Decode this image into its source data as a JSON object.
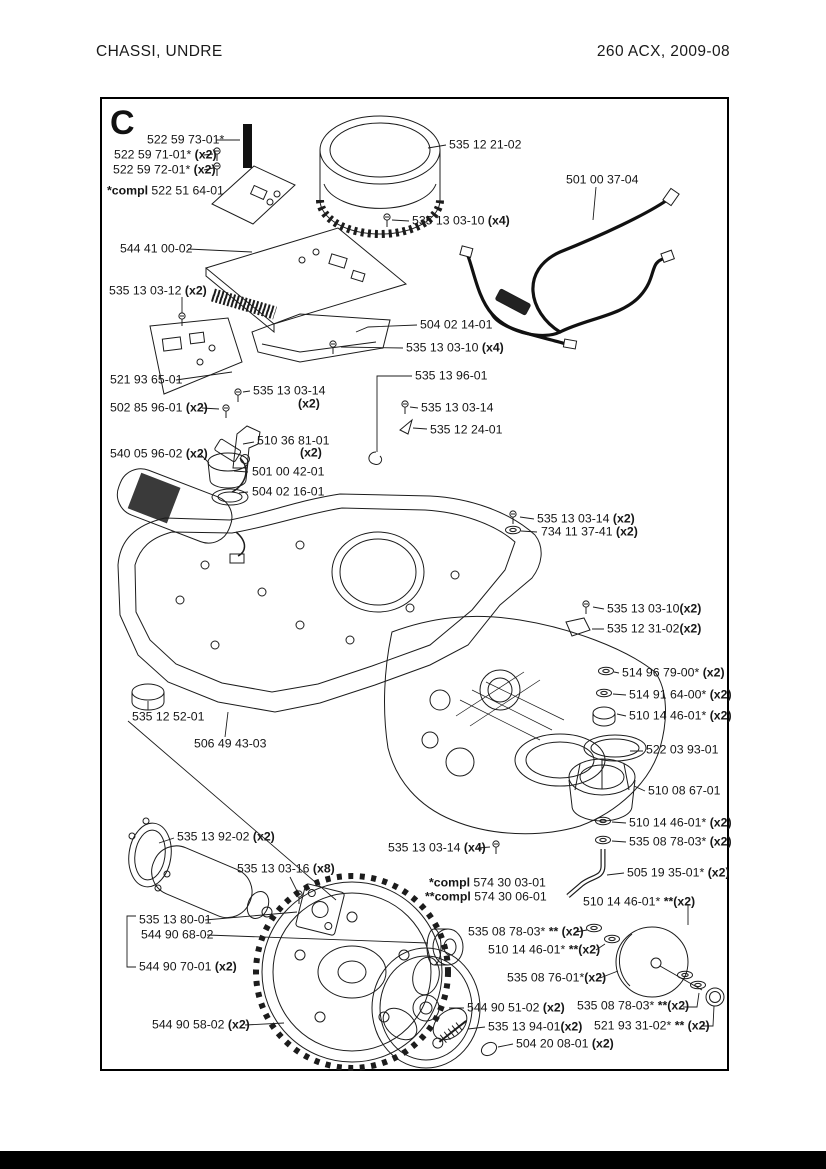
{
  "page": {
    "header_left": "CHASSI, UNDRE",
    "header_right": "260 ACX, 2009-08",
    "section_letter": "C"
  },
  "colors": {
    "line": "#1c1c1c",
    "background": "#ffffff",
    "footer_bar": "#000000"
  },
  "labels": [
    {
      "pre": "",
      "num": "522 59 73-01*",
      "qty": "",
      "x": 147,
      "y": 140
    },
    {
      "pre": "",
      "num": "522 59 71-01*",
      "qty": " (x2)",
      "x": 114,
      "y": 155
    },
    {
      "pre": "",
      "num": "522 59 72-01*",
      "qty": " (x2)",
      "x": 113,
      "y": 170
    },
    {
      "pre": "*compl ",
      "num": "522 51 64-01",
      "qty": "",
      "x": 107,
      "y": 191
    },
    {
      "pre": "",
      "num": "535 12 21-02",
      "qty": "",
      "x": 449,
      "y": 145
    },
    {
      "pre": "",
      "num": "501 00 37-04",
      "qty": "",
      "x": 566,
      "y": 180
    },
    {
      "pre": "",
      "num": "544 41 00-02",
      "qty": "",
      "x": 120,
      "y": 249
    },
    {
      "pre": "",
      "num": "535 13 03-10 ",
      "qty": "(x4)",
      "x": 412,
      "y": 221
    },
    {
      "pre": "",
      "num": "535 13 03-12 ",
      "qty": "(x2)",
      "x": 109,
      "y": 291
    },
    {
      "pre": "",
      "num": "504 02 14-01",
      "qty": "",
      "x": 420,
      "y": 325
    },
    {
      "pre": "",
      "num": "535 13 03-10",
      "qty": " (x4)",
      "x": 406,
      "y": 348
    },
    {
      "pre": "",
      "num": "535 13 96-01",
      "qty": "",
      "x": 415,
      "y": 376
    },
    {
      "pre": "",
      "num": "521 93 65-01",
      "qty": "",
      "x": 110,
      "y": 380
    },
    {
      "pre": "",
      "num": "535 13 03-14",
      "qty": "",
      "x": 253,
      "y": 391
    },
    {
      "pre": "",
      "num": "",
      "qty": "(x2)",
      "x": 298,
      "y": 404
    },
    {
      "pre": "",
      "num": "502 85 96-01 ",
      "qty": "(x2)",
      "x": 110,
      "y": 408
    },
    {
      "pre": "",
      "num": "535 13 03-14",
      "qty": "",
      "x": 421,
      "y": 408
    },
    {
      "pre": "",
      "num": "535 12 24-01",
      "qty": "",
      "x": 430,
      "y": 430
    },
    {
      "pre": "",
      "num": "510 36 81-01",
      "qty": "",
      "x": 257,
      "y": 441
    },
    {
      "pre": "",
      "num": "",
      "qty": "(x2)",
      "x": 300,
      "y": 453
    },
    {
      "pre": "",
      "num": "540 05 96-02 ",
      "qty": "(x2)",
      "x": 110,
      "y": 454
    },
    {
      "pre": "",
      "num": "501 00 42-01",
      "qty": "",
      "x": 252,
      "y": 472
    },
    {
      "pre": "",
      "num": "504 02 16-01",
      "qty": "",
      "x": 252,
      "y": 492
    },
    {
      "pre": "",
      "num": "535 13 03-14 ",
      "qty": "(x2)",
      "x": 537,
      "y": 519
    },
    {
      "pre": "",
      "num": "734 11 37-41 ",
      "qty": "(x2)",
      "x": 541,
      "y": 532
    },
    {
      "pre": "",
      "num": "535 13 03-10",
      "qty": "(x2)",
      "x": 607,
      "y": 609
    },
    {
      "pre": "",
      "num": "535 12 31-02",
      "qty": "(x2)",
      "x": 607,
      "y": 629
    },
    {
      "pre": "",
      "num": "514 96 79-00* ",
      "qty": "(x2)",
      "x": 622,
      "y": 673
    },
    {
      "pre": "",
      "num": "514 91 64-00* ",
      "qty": "(x2)",
      "x": 629,
      "y": 695
    },
    {
      "pre": "",
      "num": "510 14 46-01* ",
      "qty": "(x2)",
      "x": 629,
      "y": 716
    },
    {
      "pre": "",
      "num": "535 12 52-01",
      "qty": "",
      "x": 132,
      "y": 717
    },
    {
      "pre": "",
      "num": "506 49 43-03",
      "qty": "",
      "x": 194,
      "y": 744
    },
    {
      "pre": "",
      "num": "522 03 93-01",
      "qty": "",
      "x": 646,
      "y": 750
    },
    {
      "pre": "",
      "num": "510 08 67-01",
      "qty": "",
      "x": 648,
      "y": 791
    },
    {
      "pre": "",
      "num": "510 14 46-01* ",
      "qty": "(x2)",
      "x": 629,
      "y": 823
    },
    {
      "pre": "",
      "num": "535 08 78-03* ",
      "qty": "(x2)",
      "x": 629,
      "y": 842
    },
    {
      "pre": "",
      "num": "535 13 92-02 ",
      "qty": "(x2)",
      "x": 177,
      "y": 837
    },
    {
      "pre": "",
      "num": "535 13 03-16 ",
      "qty": "(x8)",
      "x": 237,
      "y": 869
    },
    {
      "pre": "",
      "num": "535 13 03-14 ",
      "qty": "(x4)",
      "x": 388,
      "y": 848
    },
    {
      "pre": "*compl ",
      "num": "574 30 03-01",
      "qty": "",
      "x": 429,
      "y": 883
    },
    {
      "pre": "**compl ",
      "num": "574 30 06-01",
      "qty": "",
      "x": 425,
      "y": 897
    },
    {
      "pre": "",
      "num": "505 19 35-01* ",
      "qty": "(x2)",
      "x": 627,
      "y": 873
    },
    {
      "pre": "",
      "num": "510 14 46-01* ",
      "qty": "**(x2)",
      "x": 583,
      "y": 902
    },
    {
      "pre": "",
      "num": "535 08 78-03* ",
      "qty": "** (x2)",
      "x": 468,
      "y": 932
    },
    {
      "pre": "",
      "num": "510 14 46-01* ",
      "qty": "**(x2)",
      "x": 488,
      "y": 950
    },
    {
      "pre": "",
      "num": "535 08 76-01*",
      "qty": "(x2)",
      "x": 507,
      "y": 978
    },
    {
      "pre": "",
      "num": "535 13 80-01",
      "qty": "",
      "x": 139,
      "y": 920
    },
    {
      "pre": "",
      "num": "544 90 68-02",
      "qty": "",
      "x": 141,
      "y": 935
    },
    {
      "pre": "",
      "num": "544 90 70-01 ",
      "qty": "(x2)",
      "x": 139,
      "y": 967
    },
    {
      "pre": "",
      "num": "544 90 51-02 ",
      "qty": "(x2)",
      "x": 467,
      "y": 1008
    },
    {
      "pre": "",
      "num": "535 08 78-03* ",
      "qty": "**(x2)",
      "x": 577,
      "y": 1006
    },
    {
      "pre": "",
      "num": "544 90 58-02 ",
      "qty": "(x2)",
      "x": 152,
      "y": 1025
    },
    {
      "pre": "",
      "num": "535 13 94-01",
      "qty": "(x2)",
      "x": 488,
      "y": 1027
    },
    {
      "pre": "",
      "num": "521 93 31-02* ",
      "qty": "** (x2)",
      "x": 594,
      "y": 1026
    },
    {
      "pre": "",
      "num": "504 20 08-01 ",
      "qty": "(x2)",
      "x": 516,
      "y": 1044
    }
  ]
}
